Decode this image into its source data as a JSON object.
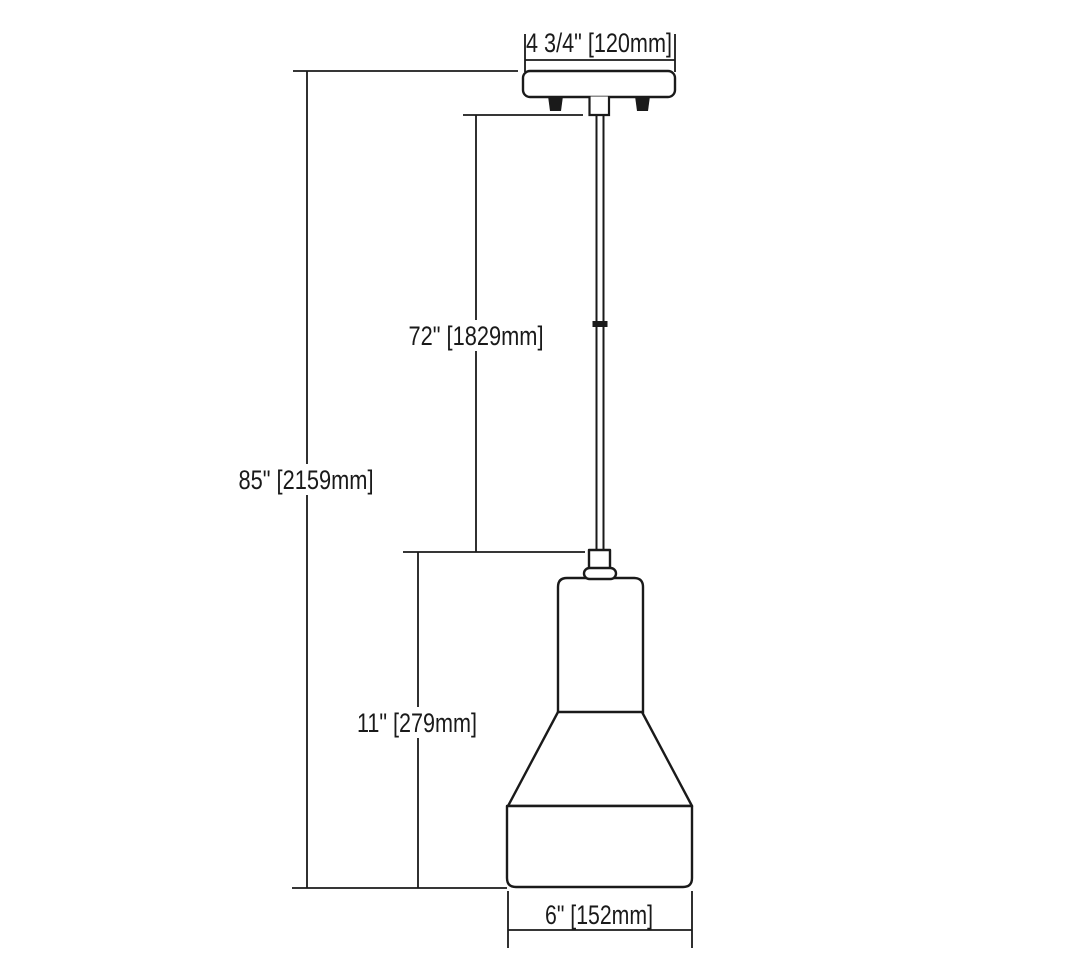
{
  "diagram": {
    "type": "dimension-drawing",
    "subject": "mini pendant light fixture line drawing with dimension callouts",
    "background_color": "#ffffff",
    "line_color": "#1a1a1a",
    "labels": {
      "canopy_width": "4 3/4\" [120mm]",
      "overall_height": "85\" [2159mm]",
      "cord_length": "72\" [1829mm]",
      "shade_height": "11\" [279mm]",
      "shade_width": "6\" [152mm]"
    },
    "dimensions": [
      {
        "name": "canopy width",
        "inches": "4 3/4",
        "millimeters": 120
      },
      {
        "name": "overall height",
        "inches": "85",
        "millimeters": 2159
      },
      {
        "name": "cord length",
        "inches": "72",
        "millimeters": 1829
      },
      {
        "name": "shade height",
        "inches": "11",
        "millimeters": 279
      },
      {
        "name": "shade width",
        "inches": "6",
        "millimeters": 152
      }
    ],
    "parts": [
      "ceiling canopy",
      "mounting screws",
      "stem",
      "suspension cord",
      "cord splice",
      "socket",
      "collar",
      "shade neck",
      "shade cone",
      "shade drum"
    ]
  }
}
